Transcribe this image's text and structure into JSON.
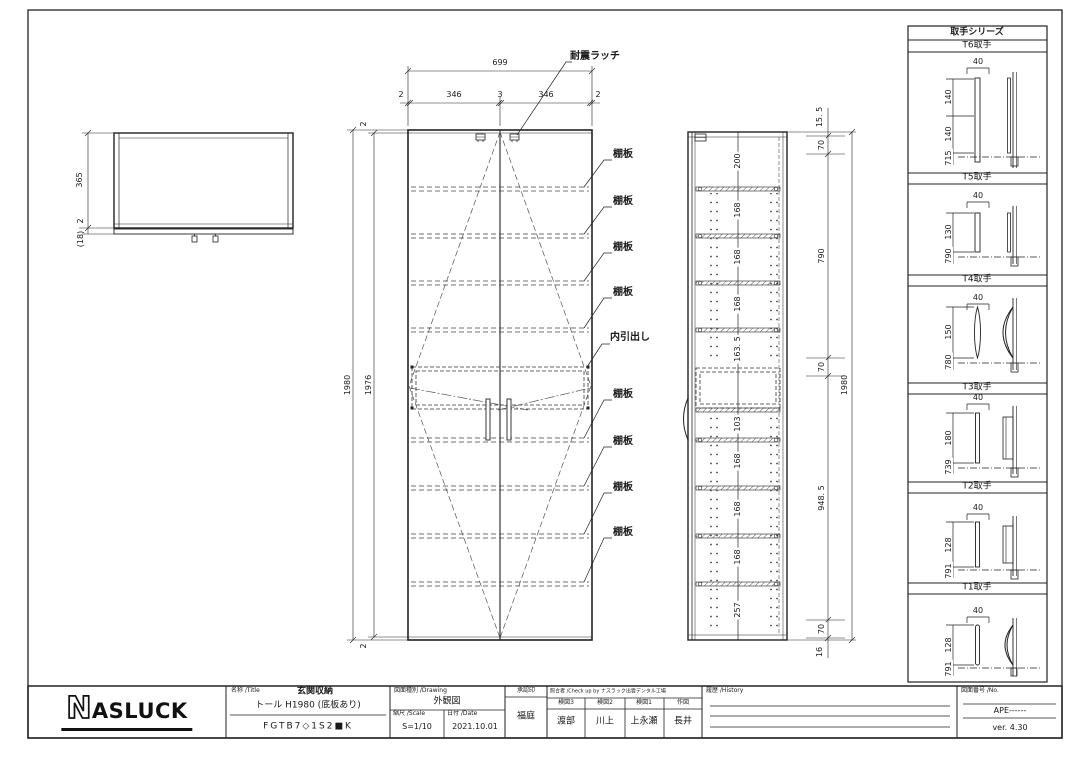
{
  "handle_panel": {
    "title": "取手シリーズ",
    "sections": [
      {
        "label": "T6取手",
        "top_dim": "40",
        "dims": [
          "140",
          "140",
          "715"
        ]
      },
      {
        "label": "T5取手",
        "top_dim": "40",
        "dims": [
          "130",
          "790"
        ]
      },
      {
        "label": "T4取手",
        "top_dim": "40",
        "dims": [
          "150",
          "780"
        ]
      },
      {
        "label": "T3取手",
        "top_dim": "40",
        "dims": [
          "180",
          "739"
        ]
      },
      {
        "label": "T2取手",
        "top_dim": "40",
        "dims": [
          "128",
          "791"
        ]
      },
      {
        "label": "T1取手",
        "top_dim": "40",
        "dims": [
          "128",
          "791"
        ]
      }
    ]
  },
  "top_view": {
    "dim_depth": "365",
    "dim_gap": "2",
    "dim_door": "(18)"
  },
  "front_view": {
    "width_total": "699",
    "width_parts": [
      "2",
      "346",
      "3",
      "346",
      "2"
    ],
    "height_outer": "1980",
    "height_inner": "1976",
    "edge_top": "2",
    "edge_bottom": "2",
    "label_latch": "耐震ラッチ",
    "label_shelf": "棚板",
    "label_drawer": "内引出し"
  },
  "side_view": {
    "internal_dims": [
      "200",
      "168",
      "168",
      "168",
      "163. 5",
      "103",
      "168",
      "168",
      "168",
      "257"
    ],
    "right_dims": [
      "15. 5",
      "70",
      "790",
      "70",
      "948. 5",
      "70",
      "16"
    ],
    "height_total": "1980"
  },
  "title_block": {
    "logo_n": "N",
    "logo_rest": "ASLUCK",
    "name_header": "名称 /Title",
    "name_value": "玄関収納",
    "name_sub": "トール H1980 (底板あり)",
    "model": "FGTB7◇1S2■K",
    "drawing_header": "図面種別 /Drawing",
    "drawing_value": "外観図",
    "scale_header": "縮尺 /Scale",
    "scale_value": "S=1/10",
    "date_header": "日付 /Date",
    "date_value": "2021.10.01",
    "approval_header": "承認印",
    "approval_value": "福庭",
    "check_header": "照合者 /Check up by ナスラック出雲デンタル工場",
    "check_cols": [
      {
        "role": "検図3",
        "name": "渡部"
      },
      {
        "role": "検図2",
        "name": "川上"
      },
      {
        "role": "検図1",
        "name": "上永瀬"
      },
      {
        "role": "作図",
        "name": "長井"
      }
    ],
    "history_header": "履歴 /History",
    "no_header": "図面番号 /No.",
    "no_value": "APE------",
    "version": "ver. 4.30"
  }
}
